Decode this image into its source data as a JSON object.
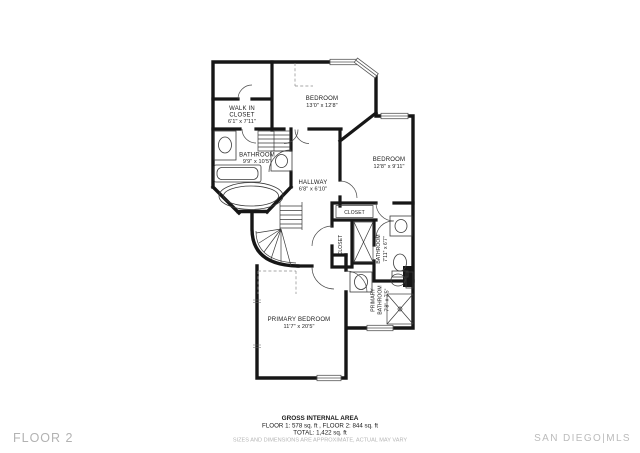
{
  "floor_plan": {
    "floor_label": "FLOOR 2",
    "brand": "SAN DIEGO|MLS",
    "colors": {
      "wall": "#161616",
      "muted_text": "#b5b5b5",
      "text": "#1a1a1a"
    },
    "rooms": {
      "walk_in_closet": {
        "line1": "WALK IN",
        "line2": "CLOSET",
        "dims": "6'1\" x 7'11\""
      },
      "bedroom_top": {
        "name": "BEDROOM",
        "dims": "13'0\" x 12'8\""
      },
      "bathroom_left": {
        "name": "BATHROOM",
        "dims": "9'9\" x 10'5\""
      },
      "hallway": {
        "name": "HALLWAY",
        "dims": "6'8\" x 6'10\""
      },
      "bedroom_right": {
        "name": "BEDROOM",
        "dims": "12'8\" x 9'11\""
      },
      "closet_top": {
        "name": "CLOSET"
      },
      "closet_side": {
        "name": "CLOSET"
      },
      "bathroom_right": {
        "name": "BATHROOM",
        "dims": "7'11\" x 6'7\""
      },
      "primary_bedroom": {
        "name": "PRIMARY BEDROOM",
        "dims": "11'7\" x 20'5\""
      },
      "primary_bathroom": {
        "line1": "PRIMARY",
        "line2": "BATHROOM",
        "dims": "7'8\" x 7'5\""
      }
    },
    "footer": {
      "title": "GROSS INTERNAL AREA",
      "floors": "FLOOR 1: 578 sq. ft , FLOOR 2: 844 sq. ft",
      "total": "TOTAL: 1,422 sq. ft",
      "disclaimer": "SIZES AND DIMENSIONS ARE APPROXIMATE, ACTUAL MAY VARY"
    }
  }
}
